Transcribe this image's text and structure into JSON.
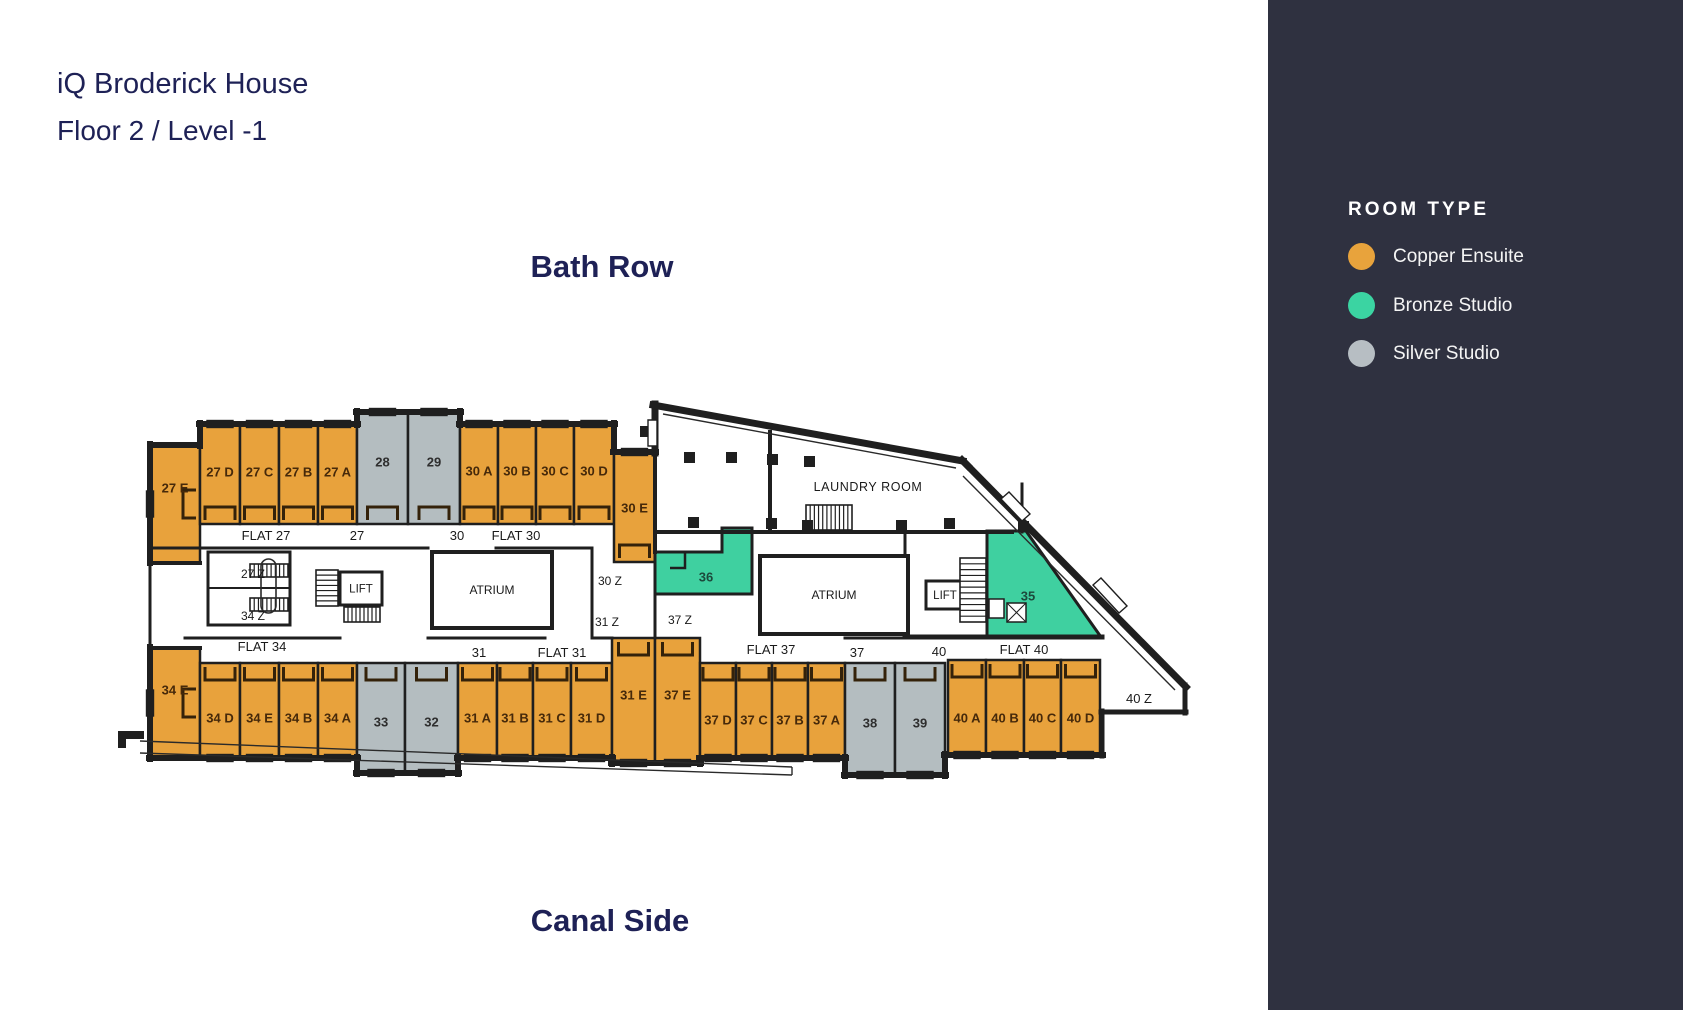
{
  "page": {
    "title_line1": "iQ Broderick House",
    "title_line2": "Floor 2 / Level -1",
    "street_top": "Bath Row",
    "street_bottom": "Canal Side"
  },
  "legend": {
    "heading": "ROOM TYPE",
    "items": [
      {
        "key": "copper",
        "label": "Copper Ensuite",
        "color": "#E8A33C"
      },
      {
        "key": "bronze",
        "label": "Bronze Studio",
        "color": "#3BD4A2"
      },
      {
        "key": "silver",
        "label": "Silver Studio",
        "color": "#B7BEC3"
      }
    ]
  },
  "colors": {
    "sidebar": "#2F3140",
    "navy": "#1E2156",
    "wall": "#1F1F1F",
    "copper": "#E8A23C",
    "bronze": "#3FD0A0",
    "silver": "#B4BDC0",
    "copper_text": "#46290A",
    "bronze_text": "#1C4A3C",
    "silver_text": "#2E2E2E",
    "label_text": "#1A1A1A"
  },
  "floorplan": {
    "rooms": [
      {
        "id": "27E",
        "label": "27 E",
        "type": "copper",
        "rect": [
          150,
          445,
          50,
          118
        ],
        "win": "left",
        "chev": "right",
        "ly": 488
      },
      {
        "id": "27D",
        "label": "27 D",
        "type": "copper",
        "rect": [
          200,
          424,
          40,
          100
        ],
        "win": "top",
        "chev": "bottom",
        "ly": 472
      },
      {
        "id": "27C",
        "label": "27 C",
        "type": "copper",
        "rect": [
          240,
          424,
          39,
          100
        ],
        "win": "top",
        "chev": "bottom",
        "ly": 472
      },
      {
        "id": "27B",
        "label": "27 B",
        "type": "copper",
        "rect": [
          279,
          424,
          39,
          100
        ],
        "win": "top",
        "chev": "bottom",
        "ly": 472
      },
      {
        "id": "27A",
        "label": "27 A",
        "type": "copper",
        "rect": [
          318,
          424,
          39,
          100
        ],
        "win": "top",
        "chev": "bottom",
        "ly": 472
      },
      {
        "id": "28",
        "label": "28",
        "type": "silver",
        "rect": [
          357,
          412,
          51,
          112
        ],
        "win": "top",
        "chev": "bottom",
        "ly": 462
      },
      {
        "id": "29",
        "label": "29",
        "type": "silver",
        "rect": [
          408,
          412,
          52,
          112
        ],
        "win": "top",
        "chev": "bottom",
        "ly": 462
      },
      {
        "id": "30A",
        "label": "30 A",
        "type": "copper",
        "rect": [
          460,
          424,
          38,
          100
        ],
        "win": "top",
        "chev": "bottom",
        "ly": 471
      },
      {
        "id": "30B",
        "label": "30 B",
        "type": "copper",
        "rect": [
          498,
          424,
          38,
          100
        ],
        "win": "top",
        "chev": "bottom",
        "ly": 471
      },
      {
        "id": "30C",
        "label": "30 C",
        "type": "copper",
        "rect": [
          536,
          424,
          38,
          100
        ],
        "win": "top",
        "chev": "bottom",
        "ly": 471
      },
      {
        "id": "30D",
        "label": "30 D",
        "type": "copper",
        "rect": [
          574,
          424,
          40,
          100
        ],
        "win": "top",
        "chev": "bottom",
        "ly": 471
      },
      {
        "id": "30E",
        "label": "30 E",
        "type": "copper",
        "rect": [
          614,
          452,
          41,
          110
        ],
        "win": "top",
        "chev": "bottom",
        "ly": 508
      },
      {
        "id": "36",
        "label": "36",
        "type": "bronze",
        "poly": [
          [
            655,
            552
          ],
          [
            722,
            552
          ],
          [
            722,
            528
          ],
          [
            752,
            528
          ],
          [
            752,
            594
          ],
          [
            655,
            594
          ]
        ],
        "label_at": [
          706,
          577
        ]
      },
      {
        "id": "35",
        "label": "35",
        "type": "bronze",
        "poly": [
          [
            987,
            531
          ],
          [
            1026,
            531
          ],
          [
            1101,
            637
          ],
          [
            987,
            637
          ]
        ],
        "label_at": [
          1028,
          596
        ]
      },
      {
        "id": "34E",
        "label": "34 E",
        "type": "copper",
        "rect": [
          150,
          648,
          50,
          110
        ],
        "win": "left",
        "chev": "right",
        "ly": 690
      },
      {
        "id": "34D",
        "label": "34 D",
        "type": "copper",
        "rect": [
          200,
          663,
          40,
          95
        ],
        "win": "bottom",
        "chev": "top",
        "ly": 718
      },
      {
        "id": "34E2",
        "label": "34 E",
        "type": "copper",
        "rect": [
          240,
          663,
          39,
          95
        ],
        "win": "bottom",
        "chev": "top",
        "ly": 718
      },
      {
        "id": "34B",
        "label": "34 B",
        "type": "copper",
        "rect": [
          279,
          663,
          39,
          95
        ],
        "win": "bottom",
        "chev": "top",
        "ly": 718
      },
      {
        "id": "34A",
        "label": "34 A",
        "type": "copper",
        "rect": [
          318,
          663,
          39,
          95
        ],
        "win": "bottom",
        "chev": "top",
        "ly": 718
      },
      {
        "id": "33",
        "label": "33",
        "type": "silver",
        "rect": [
          357,
          663,
          48,
          110
        ],
        "win": "bottom",
        "chev": "top",
        "ly": 722
      },
      {
        "id": "32",
        "label": "32",
        "type": "silver",
        "rect": [
          405,
          663,
          53,
          110
        ],
        "win": "bottom",
        "chev": "top",
        "ly": 722
      },
      {
        "id": "31A",
        "label": "31 A",
        "type": "copper",
        "rect": [
          458,
          663,
          39,
          95
        ],
        "win": "bottom",
        "chev": "top",
        "ly": 718
      },
      {
        "id": "31B",
        "label": "31 B",
        "type": "copper",
        "rect": [
          497,
          663,
          36,
          95
        ],
        "win": "bottom",
        "chev": "top",
        "ly": 718
      },
      {
        "id": "31C",
        "label": "31 C",
        "type": "copper",
        "rect": [
          533,
          663,
          38,
          95
        ],
        "win": "bottom",
        "chev": "top",
        "ly": 718
      },
      {
        "id": "31D",
        "label": "31 D",
        "type": "copper",
        "rect": [
          571,
          663,
          41,
          95
        ],
        "win": "bottom",
        "chev": "top",
        "ly": 718
      },
      {
        "id": "31E",
        "label": "31 E",
        "type": "copper",
        "rect": [
          612,
          638,
          43,
          125
        ],
        "win": "bottom",
        "chev": "top",
        "ly": 695
      },
      {
        "id": "37E",
        "label": "37 E",
        "type": "copper",
        "rect": [
          655,
          638,
          45,
          125
        ],
        "win": "bottom",
        "chev": "top",
        "ly": 695
      },
      {
        "id": "37D",
        "label": "37 D",
        "type": "copper",
        "rect": [
          700,
          663,
          36,
          95
        ],
        "win": "bottom",
        "chev": "top",
        "ly": 720
      },
      {
        "id": "37C",
        "label": "37 C",
        "type": "copper",
        "rect": [
          736,
          663,
          36,
          95
        ],
        "win": "bottom",
        "chev": "top",
        "ly": 720
      },
      {
        "id": "37B",
        "label": "37 B",
        "type": "copper",
        "rect": [
          772,
          663,
          36,
          95
        ],
        "win": "bottom",
        "chev": "top",
        "ly": 720
      },
      {
        "id": "37A",
        "label": "37 A",
        "type": "copper",
        "rect": [
          808,
          663,
          37,
          95
        ],
        "win": "bottom",
        "chev": "top",
        "ly": 720
      },
      {
        "id": "38",
        "label": "38",
        "type": "silver",
        "rect": [
          845,
          663,
          50,
          112
        ],
        "win": "bottom",
        "chev": "top",
        "ly": 723
      },
      {
        "id": "39",
        "label": "39",
        "type": "silver",
        "rect": [
          895,
          663,
          50,
          112
        ],
        "win": "bottom",
        "chev": "top",
        "ly": 723
      },
      {
        "id": "40A",
        "label": "40 A",
        "type": "copper",
        "rect": [
          948,
          660,
          38,
          95
        ],
        "win": "bottom",
        "chev": "top",
        "ly": 718
      },
      {
        "id": "40B",
        "label": "40 B",
        "type": "copper",
        "rect": [
          986,
          660,
          38,
          95
        ],
        "win": "bottom",
        "chev": "top",
        "ly": 718
      },
      {
        "id": "40C",
        "label": "40 C",
        "type": "copper",
        "rect": [
          1024,
          660,
          37,
          95
        ],
        "win": "bottom",
        "chev": "top",
        "ly": 718
      },
      {
        "id": "40D",
        "label": "40 D",
        "type": "copper",
        "rect": [
          1061,
          660,
          39,
          95
        ],
        "win": "bottom",
        "chev": "top",
        "ly": 718
      }
    ],
    "walls": [
      [
        150,
        445,
        200,
        445,
        6
      ],
      [
        200,
        446,
        200,
        423,
        6
      ],
      [
        199,
        424,
        358,
        424,
        6
      ],
      [
        357,
        425,
        357,
        411,
        6
      ],
      [
        356,
        412,
        461,
        412,
        6
      ],
      [
        460,
        411,
        460,
        425,
        6
      ],
      [
        459,
        424,
        615,
        424,
        6
      ],
      [
        614,
        423,
        614,
        452,
        6
      ],
      [
        613,
        452,
        656,
        452,
        6
      ],
      [
        655,
        453,
        655,
        404,
        7
      ],
      [
        653,
        405,
        963,
        461,
        7
      ],
      [
        962,
        460,
        968,
        466,
        7
      ],
      [
        966,
        464,
        1186,
        687,
        7
      ],
      [
        1185,
        685,
        1185,
        713,
        5
      ],
      [
        1186,
        712,
        1101,
        712,
        5
      ],
      [
        1102,
        711,
        1102,
        756,
        5
      ],
      [
        1103,
        755,
        944,
        755,
        6
      ],
      [
        945,
        754,
        945,
        776,
        6
      ],
      [
        946,
        775,
        844,
        775,
        6
      ],
      [
        845,
        776,
        845,
        757,
        6
      ],
      [
        846,
        758,
        699,
        758,
        6
      ],
      [
        700,
        759,
        700,
        764,
        6
      ],
      [
        701,
        763,
        611,
        763,
        6
      ],
      [
        612,
        764,
        612,
        757,
        6
      ],
      [
        613,
        758,
        457,
        758,
        6
      ],
      [
        458,
        757,
        458,
        774,
        6
      ],
      [
        459,
        773,
        356,
        773,
        6
      ],
      [
        357,
        774,
        357,
        757,
        6
      ],
      [
        358,
        758,
        149,
        758,
        6
      ],
      [
        150,
        759,
        150,
        647,
        6
      ],
      [
        150,
        649,
        150,
        562,
        3
      ],
      [
        150,
        563,
        150,
        444,
        6
      ],
      [
        150,
        563,
        200,
        563,
        4
      ],
      [
        150,
        648,
        200,
        648,
        4
      ],
      [
        150,
        548,
        428,
        548,
        3
      ],
      [
        496,
        548,
        592,
        548,
        3
      ],
      [
        592,
        548,
        592,
        638,
        3
      ],
      [
        208,
        552,
        290,
        552,
        3
      ],
      [
        208,
        552,
        208,
        625,
        3
      ],
      [
        290,
        552,
        290,
        625,
        3
      ],
      [
        208,
        588,
        290,
        588,
        2
      ],
      [
        208,
        625,
        290,
        625,
        3
      ],
      [
        185,
        638,
        340,
        638,
        3
      ],
      [
        428,
        638,
        545,
        638,
        3
      ],
      [
        595,
        638,
        612,
        638,
        3
      ],
      [
        655,
        452,
        655,
        552,
        4
      ],
      [
        655,
        594,
        655,
        638,
        3
      ],
      [
        905,
        637,
        1102,
        637,
        5
      ],
      [
        905,
        610,
        905,
        637,
        3
      ],
      [
        905,
        532,
        905,
        558,
        3
      ],
      [
        658,
        532,
        768,
        532,
        4
      ],
      [
        772,
        532,
        1012,
        532,
        4
      ],
      [
        770,
        432,
        770,
        532,
        4
      ],
      [
        1022,
        484,
        1022,
        532,
        3
      ],
      [
        845,
        638,
        905,
        638,
        3
      ]
    ],
    "thin_lines": [
      [
        663,
        414,
        956,
        468
      ],
      [
        963,
        476,
        1175,
        690
      ],
      [
        140,
        741,
        792,
        767
      ],
      [
        140,
        753,
        792,
        775
      ],
      [
        792,
        767,
        792,
        775
      ]
    ],
    "areas": [
      {
        "label": "ATRIUM",
        "rect": [
          432,
          552,
          120,
          76
        ],
        "fs": 12,
        "sw": 4
      },
      {
        "label": "ATRIUM",
        "rect": [
          760,
          556,
          148,
          78
        ],
        "fs": 12,
        "sw": 4
      },
      {
        "label": "LIFT",
        "rect": [
          340,
          572,
          42,
          33
        ],
        "fs": 11.5,
        "sw": 3
      },
      {
        "label": "LIFT",
        "rect": [
          926,
          581,
          38,
          28
        ],
        "fs": 11.5,
        "sw": 3
      }
    ],
    "stairs": [
      {
        "x": 316,
        "y": 570,
        "w": 22,
        "h": 36,
        "d": "h",
        "n": 7
      },
      {
        "x": 344,
        "y": 607,
        "w": 36,
        "h": 15,
        "d": "v",
        "n": 9
      },
      {
        "x": 250,
        "y": 564,
        "w": 38,
        "h": 13,
        "d": "v",
        "n": 9
      },
      {
        "x": 250,
        "y": 598,
        "w": 38,
        "h": 13,
        "d": "v",
        "n": 9
      },
      {
        "x": 960,
        "y": 558,
        "w": 26,
        "h": 64,
        "d": "h",
        "n": 11
      },
      {
        "x": 806,
        "y": 505,
        "w": 46,
        "h": 25,
        "d": "v",
        "n": 11
      }
    ],
    "columns": [
      [
        640,
        426
      ],
      [
        684,
        452
      ],
      [
        726,
        452
      ],
      [
        767,
        454
      ],
      [
        804,
        456
      ],
      [
        688,
        517
      ],
      [
        766,
        518
      ],
      [
        802,
        520
      ],
      [
        896,
        520
      ],
      [
        944,
        518
      ],
      [
        1018,
        521
      ]
    ],
    "windows_extra": [
      [
        [
          648,
          420
        ],
        [
          657,
          420
        ],
        [
          657,
          446
        ],
        [
          648,
          446
        ]
      ],
      [
        [
          1001,
          499
        ],
        [
          1009,
          492
        ],
        [
          1030,
          514
        ],
        [
          1022,
          521
        ]
      ],
      [
        [
          1093,
          585
        ],
        [
          1101,
          578
        ],
        [
          1127,
          606
        ],
        [
          1119,
          613
        ]
      ]
    ],
    "bath_fixtures": [
      [
        989,
        599,
        15,
        19
      ],
      [
        1007,
        603,
        19,
        19
      ]
    ],
    "stair_loop": [
      261,
      559,
      15,
      54
    ],
    "balcony_blocks": [
      [
        118,
        731,
        26,
        8
      ],
      [
        118,
        731,
        8,
        17
      ]
    ],
    "labels": [
      {
        "t": "FLAT 27",
        "x": 266,
        "y": 540,
        "fs": 13
      },
      {
        "t": "27",
        "x": 357,
        "y": 540,
        "fs": 13
      },
      {
        "t": "30",
        "x": 457,
        "y": 540,
        "fs": 13
      },
      {
        "t": "FLAT 30",
        "x": 516,
        "y": 540,
        "fs": 13
      },
      {
        "t": "27 Z",
        "x": 253,
        "y": 578,
        "fs": 12
      },
      {
        "t": "34 Z",
        "x": 253,
        "y": 620,
        "fs": 12
      },
      {
        "t": "30 Z",
        "x": 610,
        "y": 585,
        "fs": 12
      },
      {
        "t": "31 Z",
        "x": 607,
        "y": 626,
        "fs": 12
      },
      {
        "t": "37 Z",
        "x": 680,
        "y": 624,
        "fs": 12
      },
      {
        "t": "FLAT 34",
        "x": 262,
        "y": 651,
        "fs": 13
      },
      {
        "t": "31",
        "x": 479,
        "y": 657,
        "fs": 13
      },
      {
        "t": "FLAT 31",
        "x": 562,
        "y": 657,
        "fs": 13
      },
      {
        "t": "FLAT 37",
        "x": 771,
        "y": 654,
        "fs": 13
      },
      {
        "t": "37",
        "x": 857,
        "y": 657,
        "fs": 13
      },
      {
        "t": "40",
        "x": 939,
        "y": 656,
        "fs": 13
      },
      {
        "t": "FLAT 40",
        "x": 1024,
        "y": 654,
        "fs": 13
      },
      {
        "t": "40 Z",
        "x": 1139,
        "y": 703,
        "fs": 13
      },
      {
        "t": "LAUNDRY ROOM",
        "x": 868,
        "y": 491,
        "fs": 12.5,
        "ls": 0.6
      }
    ]
  }
}
